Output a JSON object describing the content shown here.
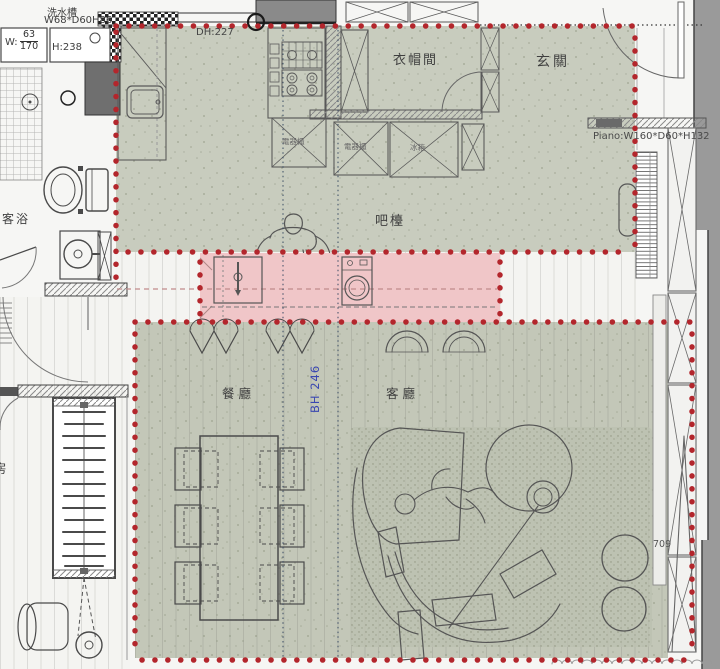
{
  "meta": {
    "type": "interior-floor-plan"
  },
  "colors": {
    "zone_green_upper": "#c8ccbe",
    "zone_green_lower": "#c3c7b8",
    "bar_pink": "#f0c6c8",
    "marker_red": "#b3262c",
    "beam_blue": "#3a47b0"
  },
  "labels": {
    "sink_unit": {
      "line1": "洗水槽",
      "line2": "W68*D60H86"
    },
    "window": {
      "prefix": "W:",
      "numerator": "63",
      "denominator": "170"
    },
    "height_note": "H:238",
    "door_height": "DH:227",
    "closet_room": "衣帽間",
    "foyer": "玄關",
    "appliance_cab_a": "電器櫃",
    "appliance_cab_b": "電器櫃",
    "fridge": "冰箱",
    "bar_counter": "吧檯",
    "piano_dim": "Piano:W160*D60*H132",
    "guest_bath": "客浴",
    "dining_room": "餐廳",
    "living_room": "客廳",
    "beam_height": "BH 246",
    "room_partial": "房",
    "dim_709": "709"
  }
}
